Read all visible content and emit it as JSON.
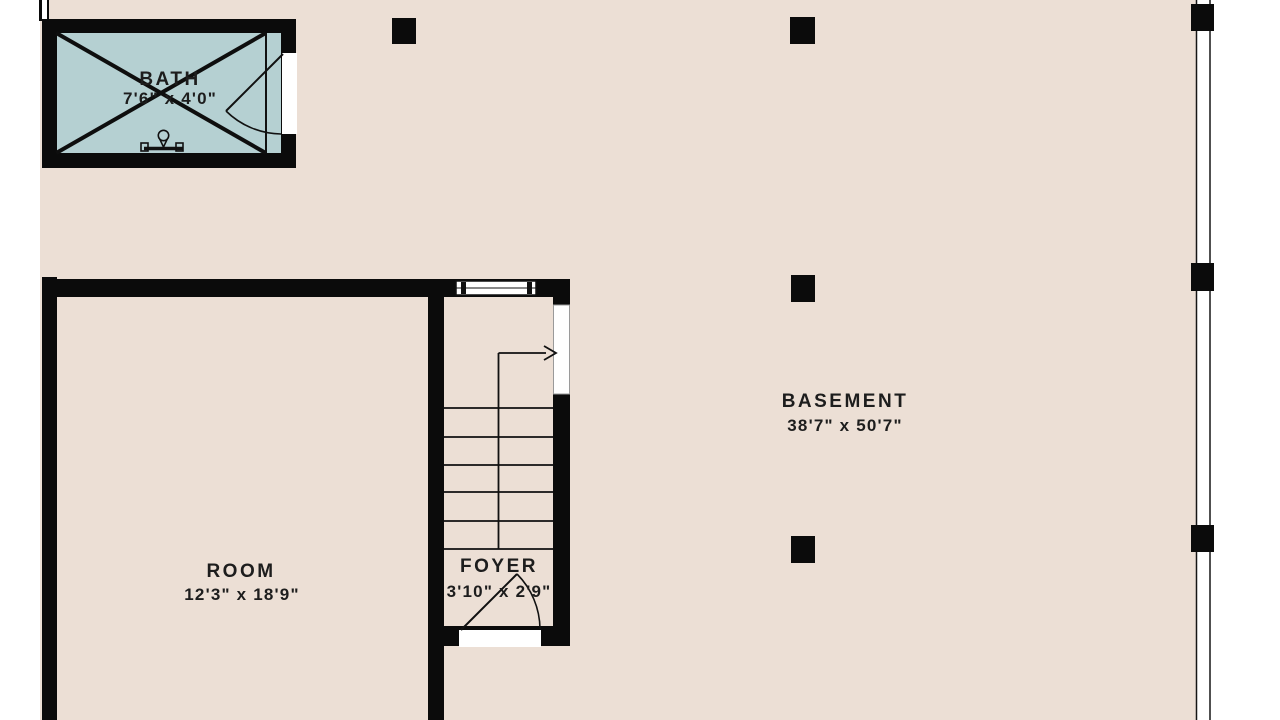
{
  "rooms": {
    "bath": {
      "name": "BATH",
      "dimensions": "7'6\" x 4'0\""
    },
    "room": {
      "name": "ROOM",
      "dimensions": "12'3\" x 18'9\""
    },
    "foyer": {
      "name": "FOYER",
      "dimensions": "3'10\" x 2'9\""
    },
    "basement": {
      "name": "BASEMENT",
      "dimensions": "38'7\" x 50'7\""
    }
  },
  "colors": {
    "background": "#ecdfd5",
    "bath_fill": "#b5d0d2",
    "wall": "#0b0b0b",
    "text": "#1d1d1d",
    "exterior": "#ffffff"
  }
}
